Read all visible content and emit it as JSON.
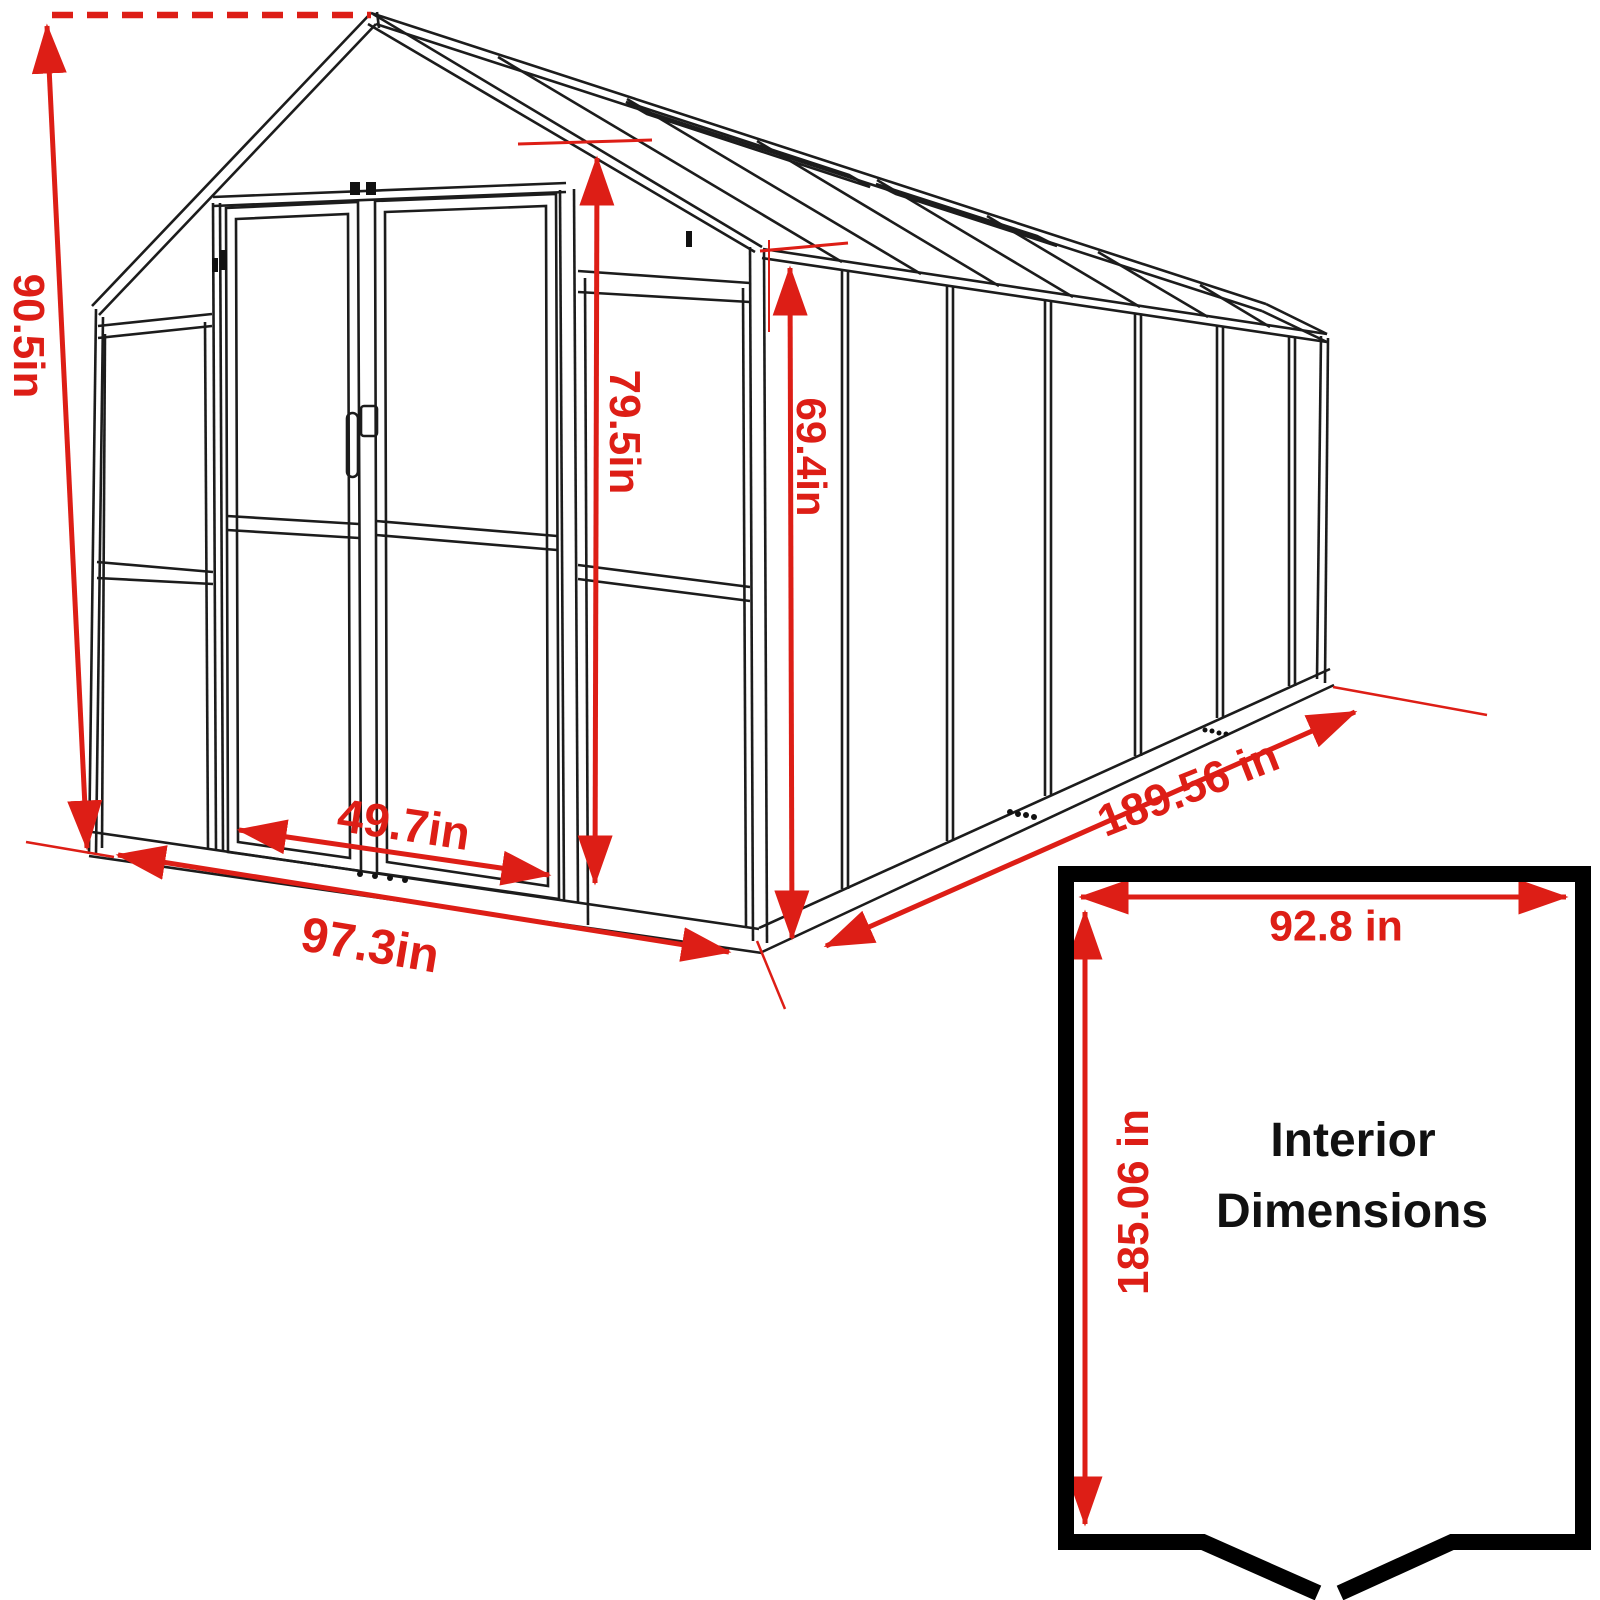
{
  "palette": {
    "accent_red": "#dd1e16",
    "line_black": "#1c1c1c",
    "background": "#ffffff"
  },
  "dimensions": {
    "overall_height": "90.5in",
    "door_height": "79.5in",
    "eave_height": "69.4in",
    "door_width": "49.7in",
    "front_width": "97.3in",
    "side_length": "189.56 in"
  },
  "interior_box": {
    "width": "92.8 in",
    "depth": "185.06 in",
    "label_line1": "Interior",
    "label_line2": "Dimensions"
  }
}
